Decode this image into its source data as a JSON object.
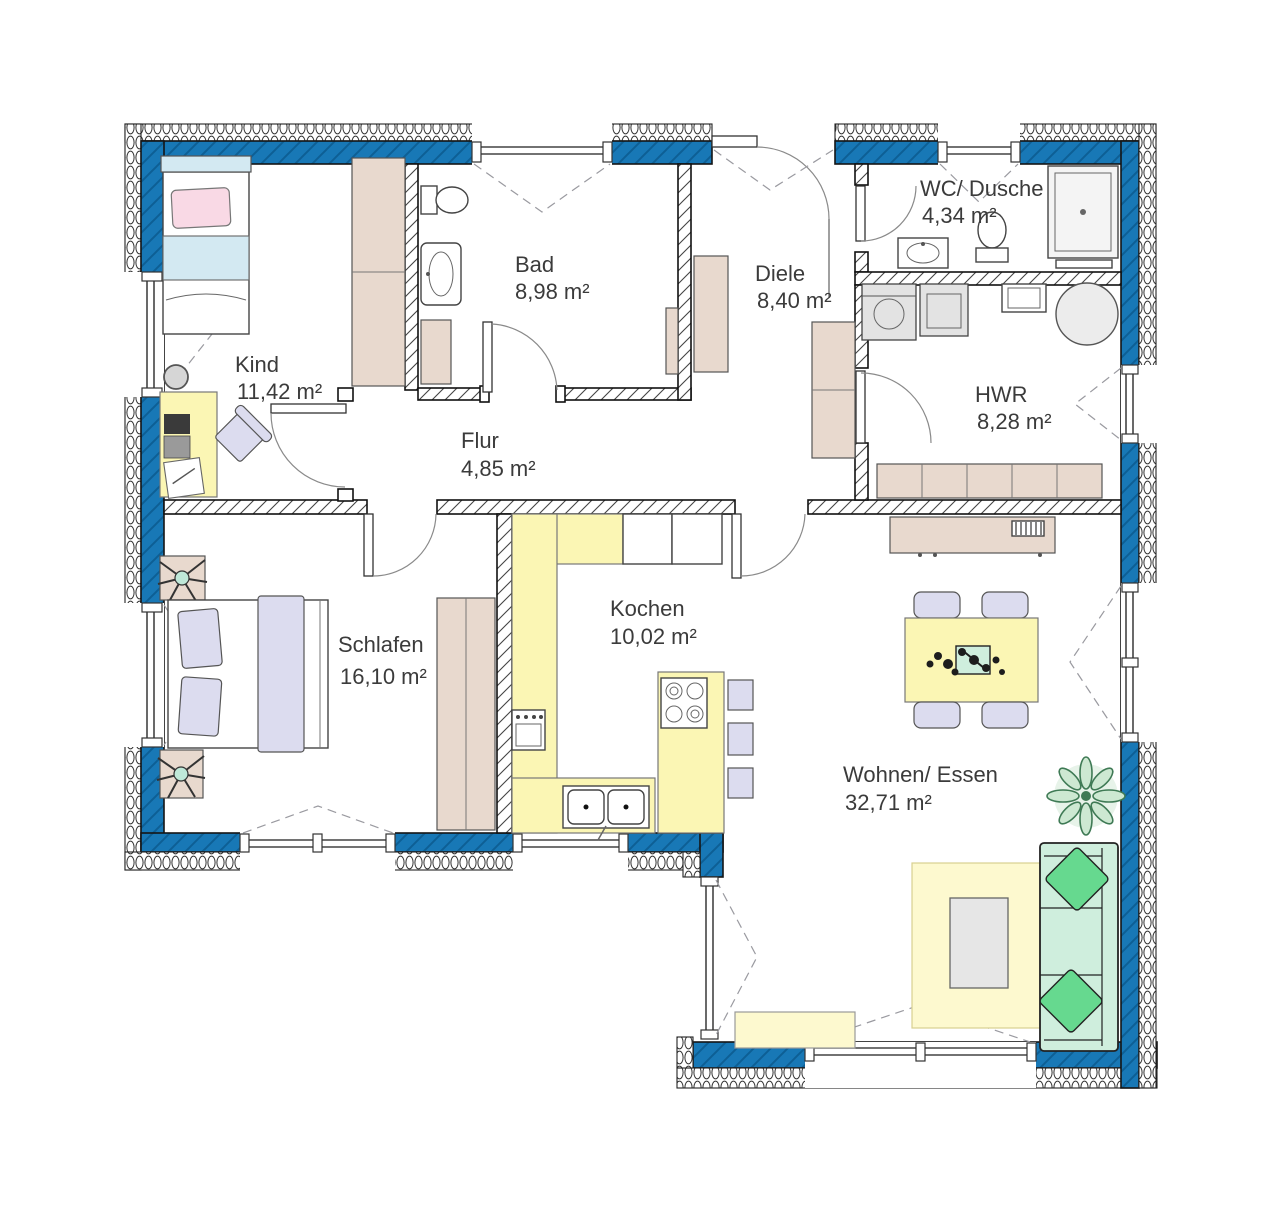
{
  "rooms": [
    {
      "id": "kind",
      "name": "Kind",
      "area": "11,42 m²"
    },
    {
      "id": "bad",
      "name": "Bad",
      "area": "8,98 m²"
    },
    {
      "id": "diele",
      "name": "Diele",
      "area": "8,40 m²"
    },
    {
      "id": "wc-dusche",
      "name": "WC/ Dusche",
      "area": "4,34 m²"
    },
    {
      "id": "hwr",
      "name": "HWR",
      "area": "8,28 m²"
    },
    {
      "id": "flur",
      "name": "Flur",
      "area": "4,85 m²"
    },
    {
      "id": "schlafen",
      "name": "Schlafen",
      "area": "16,10 m²"
    },
    {
      "id": "kochen",
      "name": "Kochen",
      "area": "10,02 m²"
    },
    {
      "id": "wohnen-essen",
      "name": "Wohnen/ Essen",
      "area": "32,71 m²"
    }
  ],
  "colors": {
    "wall_blue": "#1878b6",
    "wall_blue_stripe": "#0d5f95",
    "furniture_beige": "#e8d9ce",
    "furniture_yellow": "#fbf6b4",
    "furniture_lavender": "#dcdcef",
    "furniture_green": "#cfeedd",
    "pillow_green": "#66d98f",
    "pillow_pink": "#f9d9e5",
    "blanket_blue": "#d3e9f2",
    "appliance_gray": "#e3e3e3",
    "label_text": "#3b3b3b"
  }
}
